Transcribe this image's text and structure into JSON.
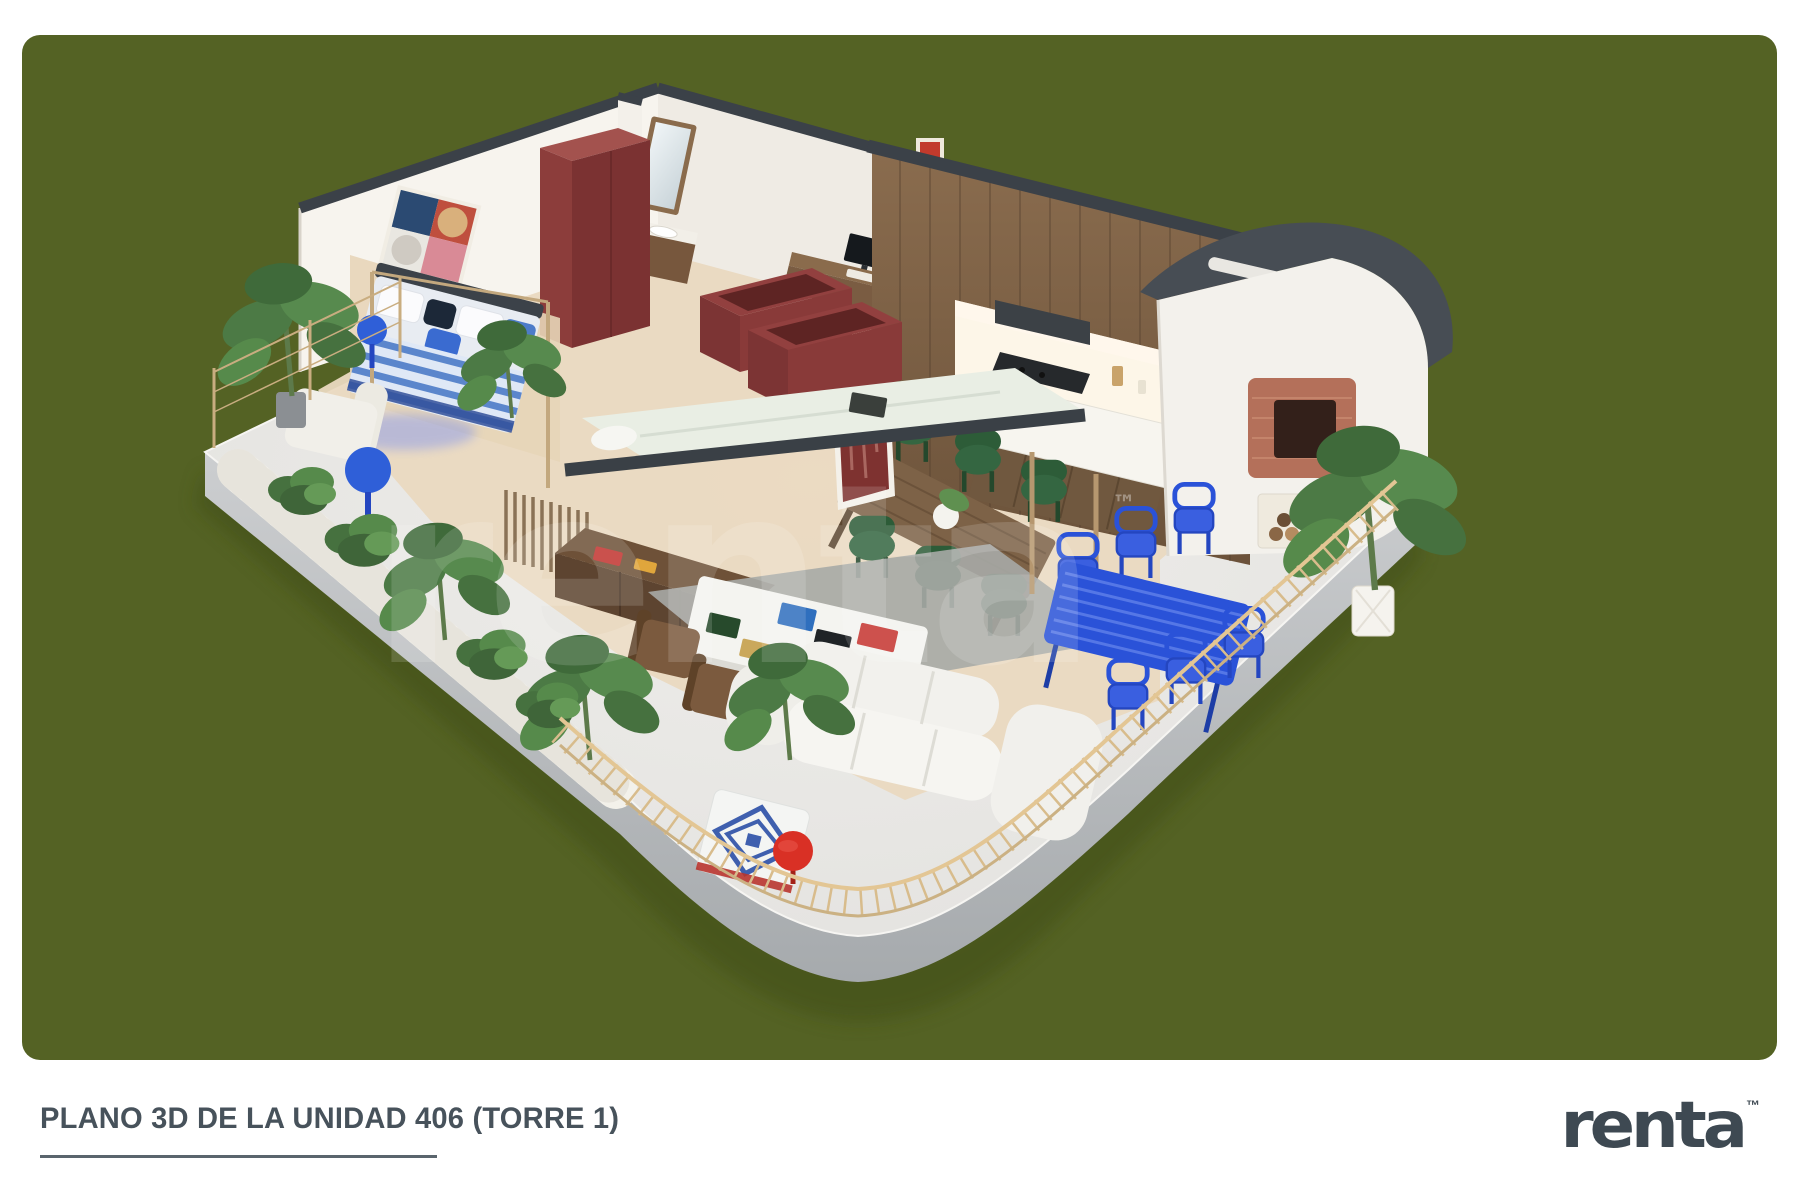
{
  "page": {
    "background": "#ffffff"
  },
  "panel": {
    "background": "#546224",
    "border_radius": 18
  },
  "caption": {
    "title": "PLANO 3D DE LA UNIDAD 406 (TORRE 1)"
  },
  "brand": {
    "name": "renta",
    "trademark": "™",
    "color": "#3e4952"
  },
  "watermark": {
    "text": "renta",
    "trademark": "™"
  },
  "colors": {
    "olive_background": "#546224",
    "wall_white": "#f7f4ee",
    "wall_cap_dark": "#3b4148",
    "kitchen_wood": "#7c6148",
    "maroon_furniture": "#8c3d3b",
    "bed_blue": "#5b86cc",
    "royal_blue_outdoor": "#2a52d8",
    "dining_chair_green": "#2d5c38",
    "terrace_gray": "#e8e7e4",
    "plinth_gray": "#b7babd",
    "railing_tan": "#d8bc8c",
    "brick_red": "#b4705a",
    "poster_red": "#7e3230",
    "logo_slate": "#3e4952"
  }
}
